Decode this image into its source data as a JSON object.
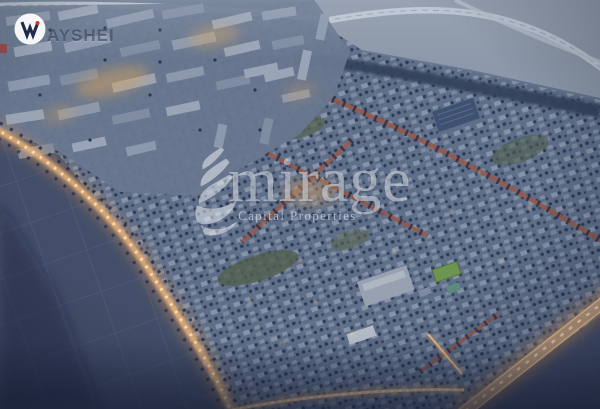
{
  "meta": {
    "title": "Dusk aerial render of residential masterplan community"
  },
  "scene": {
    "description": "Aerial evening render of a coastal masterplan: apartment district, villa neighborhoods, illuminated boulevards and highway, school campus with sports pitch, solar array, and undeveloped parcels",
    "features": [
      "apartment-district",
      "villa-neighborhoods",
      "illuminated-arterial-road",
      "illuminated-highway",
      "red-tree-lined-avenues",
      "school-campus",
      "sports-pitch",
      "solar-array",
      "undeveloped-land",
      "coastal-road"
    ],
    "palette": {
      "district_base": "#5f6f8a",
      "apartment_block": "#8c98ac",
      "empty_land": "#8d99aa",
      "dark_land": "#434f6a",
      "tree": "#27334e",
      "road_light_glow": "#e8b07a",
      "road_light_core": "#ffdfae",
      "red_avenue": "#96594a",
      "sports_pitch": "#6d9551",
      "solar_array": "#3e5170"
    }
  },
  "watermarks": {
    "ayshei": {
      "label": "AYSHEI",
      "logo_glyph": "W",
      "logo_bg": "#ffffff",
      "logo_glyph_color": "#1e2a49",
      "logo_accent": "#c9372e"
    },
    "mirage": {
      "brand": "mirage",
      "tagline": "Capital Properties",
      "color": "#f2f6fa"
    }
  }
}
